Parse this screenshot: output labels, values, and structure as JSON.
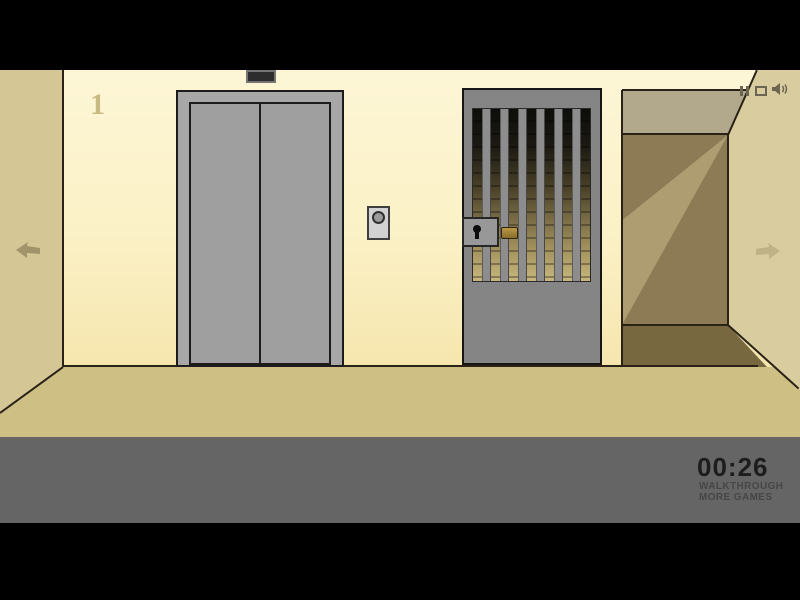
{
  "scene": {
    "floor_number": "1"
  },
  "hud": {
    "timer": "00:26",
    "walkthrough": "WALKTHROUGH",
    "more_games": "MORE GAMES"
  },
  "icons": {
    "pause": "pause-icon",
    "quality": "quality-icon",
    "sound": "sound-on-icon",
    "arrow_left": "arrow-left-icon",
    "arrow_right": "arrow-right-icon"
  },
  "colors": {
    "wall_cream": "#fbf1c6",
    "side_wall_tan": "#d5c795",
    "near_wall_tan": "#d9cc9e",
    "floor_tan": "#cec085",
    "corridor_dark": "#8c7b54",
    "elevator_gray": "#a7a7a7",
    "gate_gray": "#858585",
    "brass": "#a5853a",
    "hud_bar_gray": "#656565",
    "timer_text": "#1d1d1d"
  }
}
